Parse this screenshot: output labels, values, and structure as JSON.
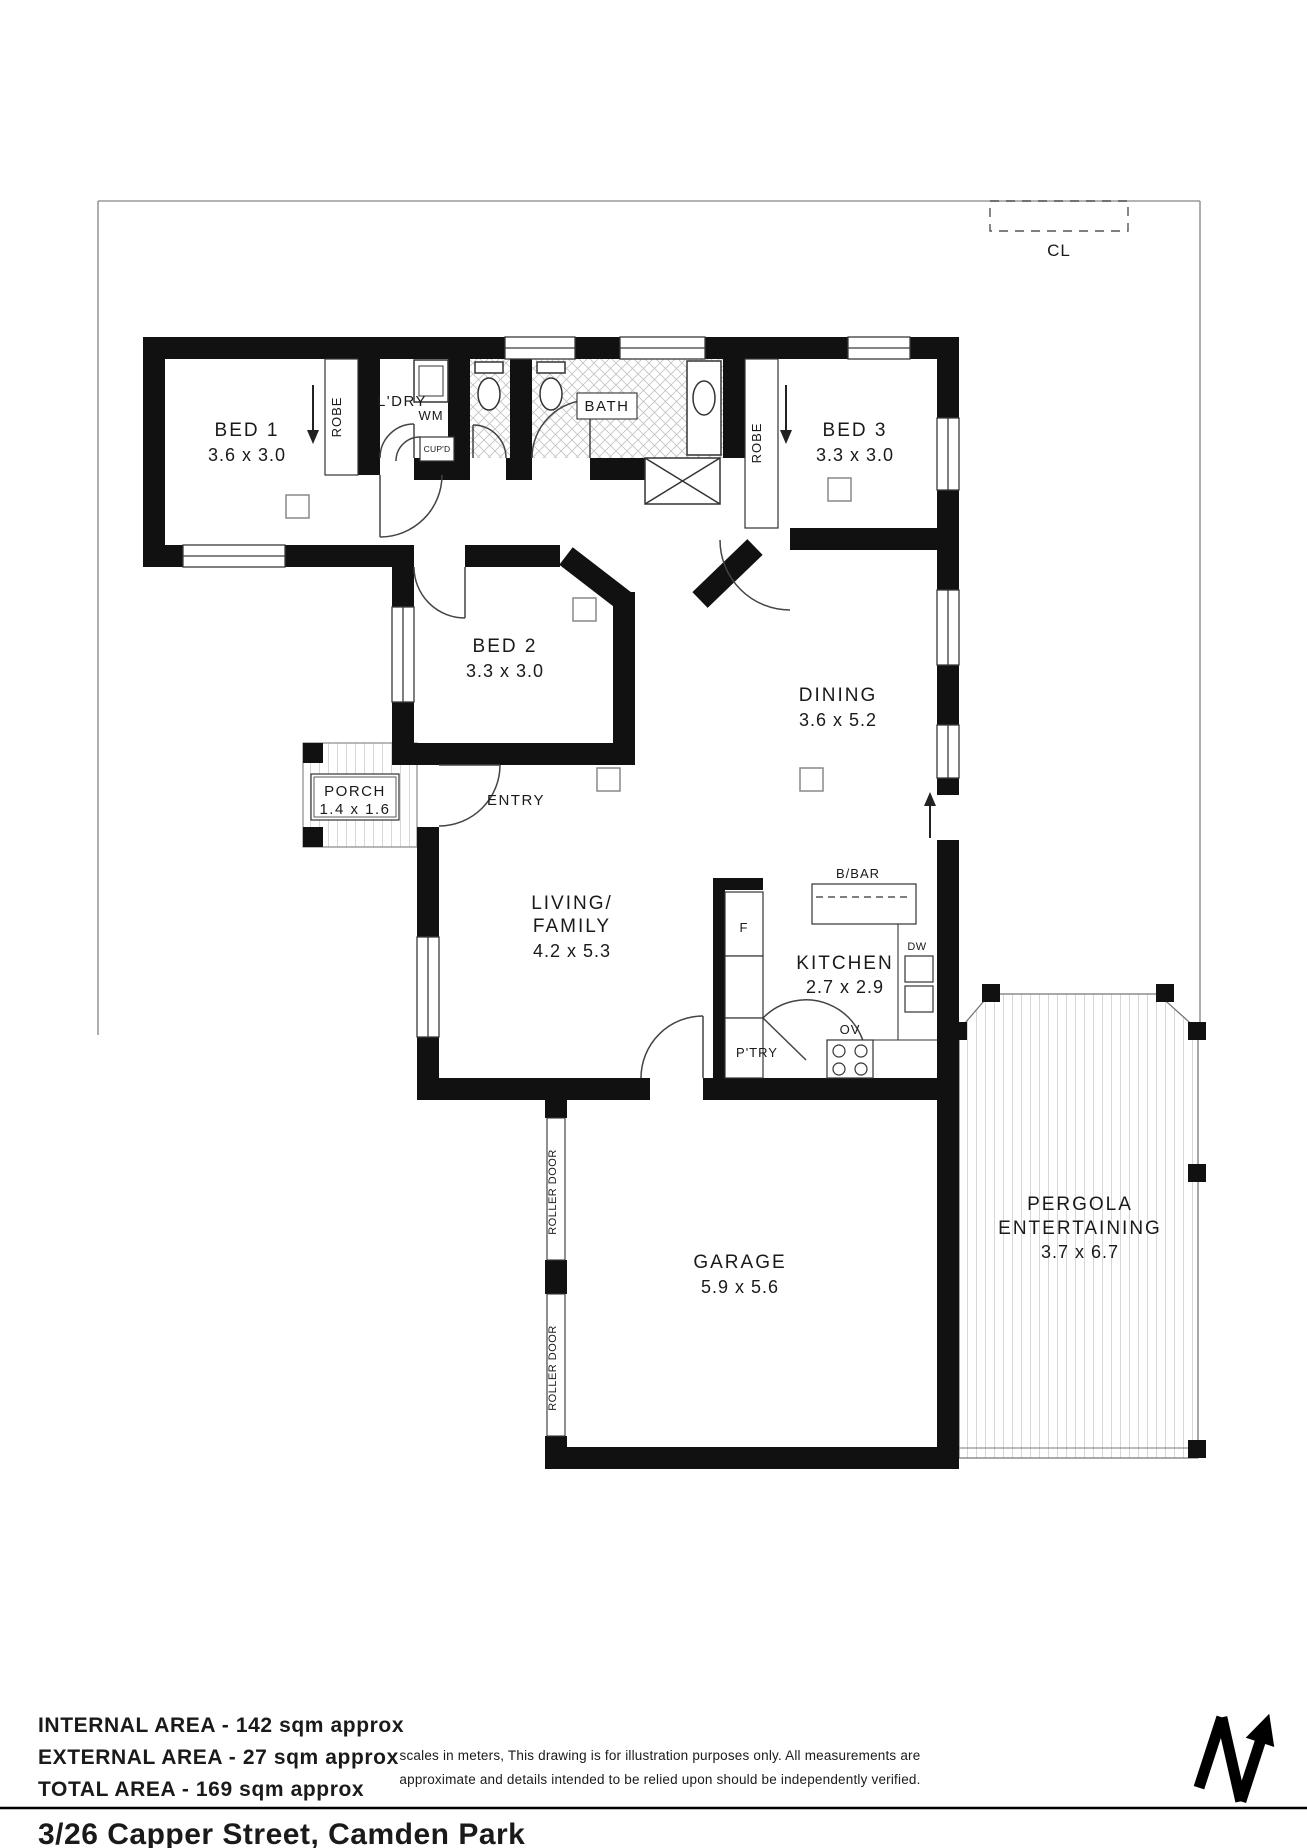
{
  "site": {
    "clothesline": "CL",
    "north": "N"
  },
  "rooms": {
    "bed1": {
      "name": "BED 1",
      "dims": "3.6 x 3.0"
    },
    "bed2": {
      "name": "BED 2",
      "dims": "3.3 x 3.0"
    },
    "bed3": {
      "name": "BED 3",
      "dims": "3.3 x 3.0"
    },
    "dining": {
      "name": "DINING",
      "dims": "3.6 x 5.2"
    },
    "kitchen": {
      "name": "KITCHEN",
      "dims": "2.7 x 2.9"
    },
    "living": {
      "name1": "LIVING/",
      "name2": "FAMILY",
      "dims": "4.2 x 5.3"
    },
    "garage": {
      "name": "GARAGE",
      "dims": "5.9 x 5.6"
    },
    "pergola": {
      "name1": "PERGOLA",
      "name2": "ENTERTAINING",
      "dims": "3.7 x 6.7"
    },
    "porch": {
      "name": "PORCH",
      "dims": "1.4 x 1.6"
    },
    "entry": {
      "name": "ENTRY"
    },
    "laundry": {
      "name": "L'DRY"
    },
    "bath": {
      "name": "BATH"
    }
  },
  "fixtures": {
    "wm": "WM",
    "cupd": "CUP'D",
    "robe1": "ROBE",
    "robe3": "ROBE",
    "fridge": "F",
    "dishwasher": "DW",
    "oven": "OV",
    "pantry": "P'TRY",
    "breakfast_bar": "B/BAR",
    "roller1": "ROLLER DOOR",
    "roller2": "ROLLER DOOR"
  },
  "areas": {
    "internal": "INTERNAL AREA - 142 sqm approx",
    "external": "EXTERNAL AREA - 27 sqm approx",
    "total": "TOTAL AREA - 169 sqm approx"
  },
  "disclaimer": {
    "line1": "scales in meters, This drawing is for illustration purposes only. All measurements are",
    "line2": "approximate and details intended to be relied upon should be independently verified."
  },
  "footer": {
    "address": "3/26 Capper Street, Camden Park"
  }
}
